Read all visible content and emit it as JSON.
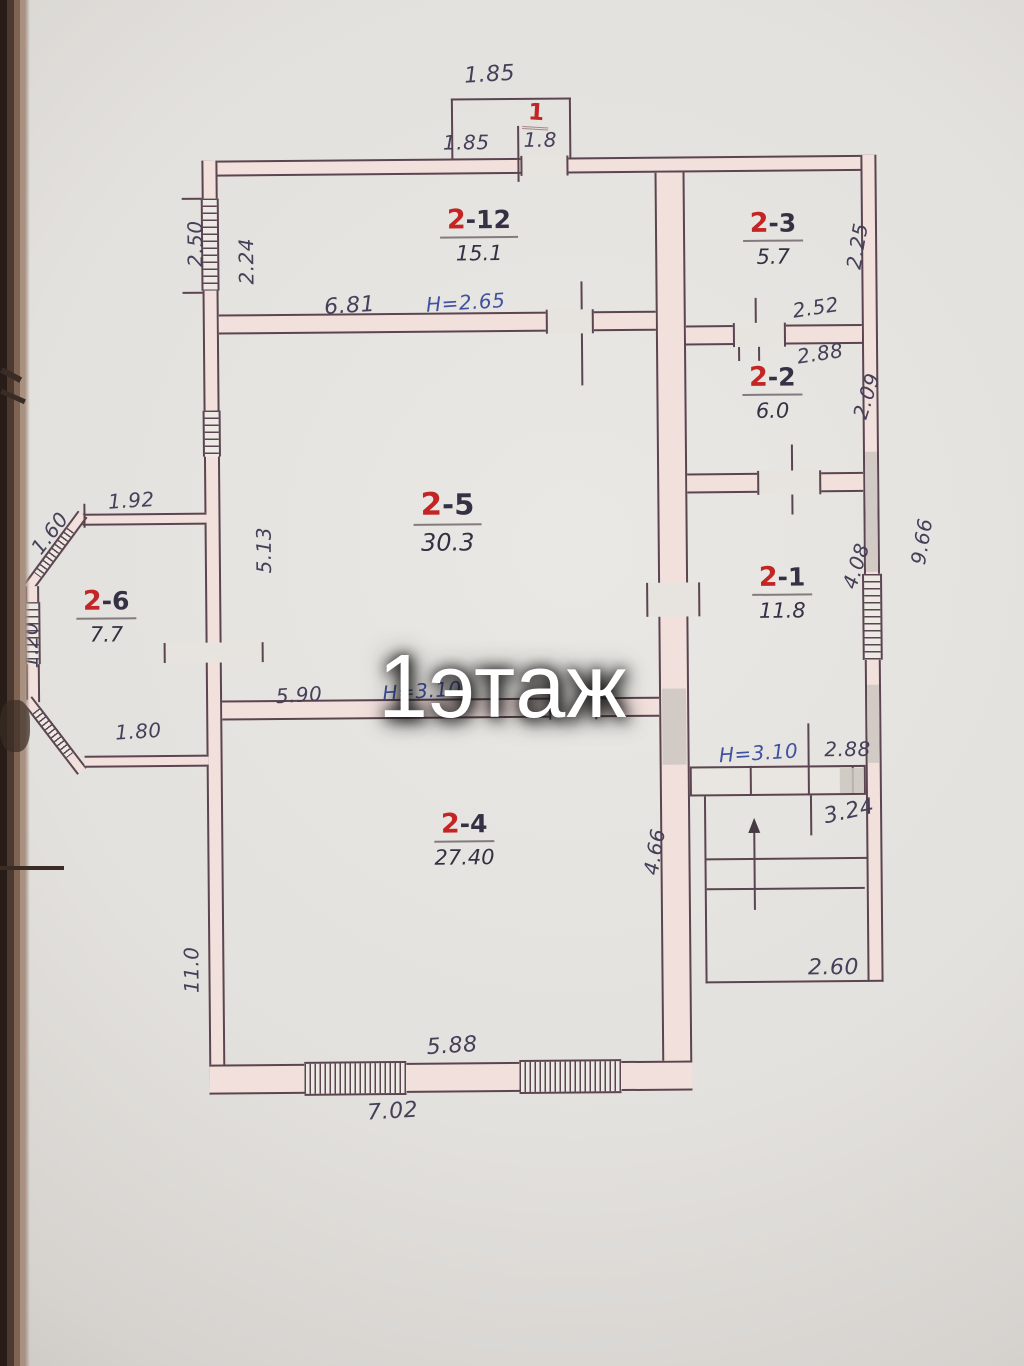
{
  "watermark": "1этаж",
  "colors": {
    "room_number_red": "#c32525",
    "ink_dark": "#463f59",
    "ink_blue": "#3f51a0",
    "wall_fill_pink": "#f1e0dc",
    "wall_line": "#5a4550",
    "paper": "#e3e1dd"
  },
  "porch": {
    "top_width": "1.85",
    "number": "1",
    "inner_left": "1.85",
    "inner_right": "1.8"
  },
  "rooms": {
    "r212": {
      "no": "2",
      "suf": "-12",
      "area": "15.1"
    },
    "r23": {
      "no": "2",
      "suf": "-3",
      "area": "5.7"
    },
    "r22": {
      "no": "2",
      "suf": "-2",
      "area": "6.0"
    },
    "r25": {
      "no": "2",
      "suf": "-5",
      "area": "30.3"
    },
    "r21": {
      "no": "2",
      "suf": "-1",
      "area": "11.8"
    },
    "r26": {
      "no": "2",
      "suf": "-6",
      "area": "7.7"
    },
    "r24": {
      "no": "2",
      "suf": "-4",
      "area": "27.40"
    }
  },
  "dims": {
    "d250": "2.50",
    "d224": "2.24",
    "d681": "6.81",
    "h265": "H=2.65",
    "d225": "2.25",
    "d252": "2.52",
    "d288a": "2.88",
    "d209": "2.09",
    "d192": "1.92",
    "d160": "1.60",
    "d120": "1.20",
    "d180": "1.80",
    "d513": "5.13",
    "d590": "5.90",
    "hmid": "H=3.10",
    "d408": "4.08",
    "d966": "9.66",
    "h310": "H=3.10",
    "d288b": "2.88",
    "d324": "3.24",
    "d466": "4.66",
    "d260": "2.60",
    "d110": "11.0",
    "d588": "5.88",
    "d702": "7.02"
  }
}
